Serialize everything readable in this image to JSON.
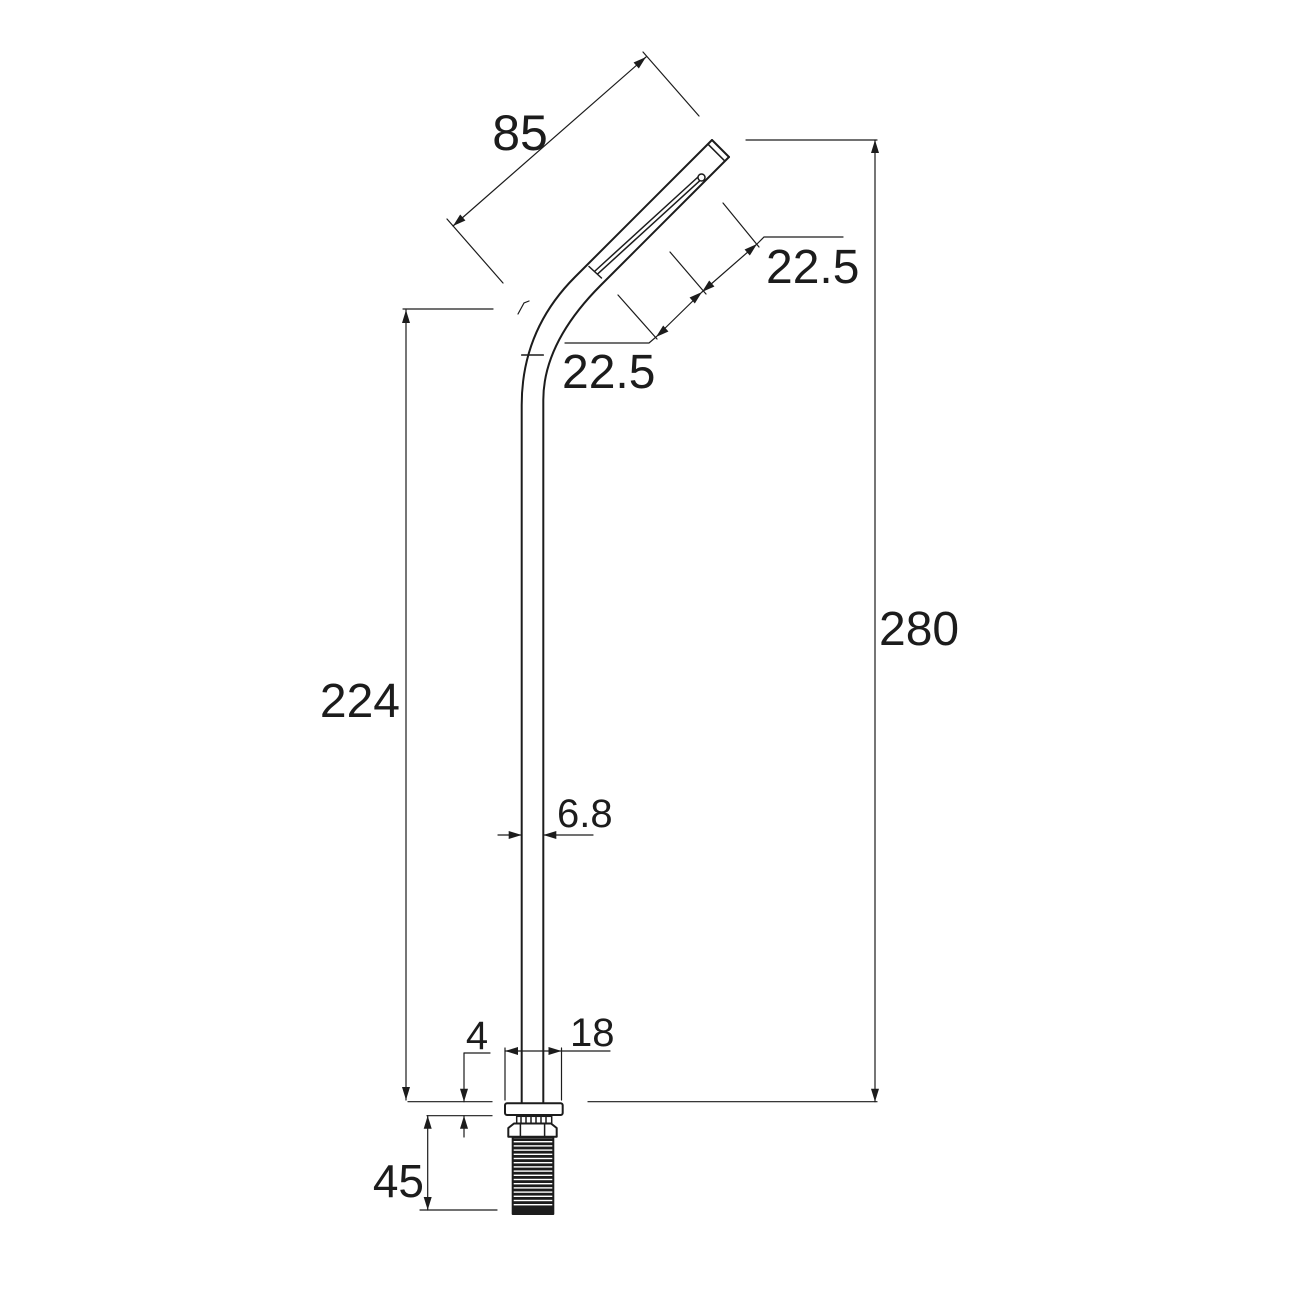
{
  "canvas": {
    "width": 1293,
    "height": 1292,
    "background": "#ffffff",
    "line_color": "#1c1c1c"
  },
  "drawing": {
    "type": "technical-dimension-drawing",
    "subject": "tall angled-head tap / spout with flange, lock nut and threaded tail",
    "units_shown": false
  },
  "dims": {
    "spout_length": {
      "label": "85"
    },
    "head_offset_upper": {
      "label": "22.5"
    },
    "head_offset_lower": {
      "label": "22.5"
    },
    "body_height": {
      "label": "224"
    },
    "overall_height": {
      "label": "280"
    },
    "pole_width": {
      "label": "6.8"
    },
    "flange_thickness": {
      "label": "4"
    },
    "flange_width": {
      "label": "18"
    },
    "thread_length": {
      "label": "45"
    }
  }
}
